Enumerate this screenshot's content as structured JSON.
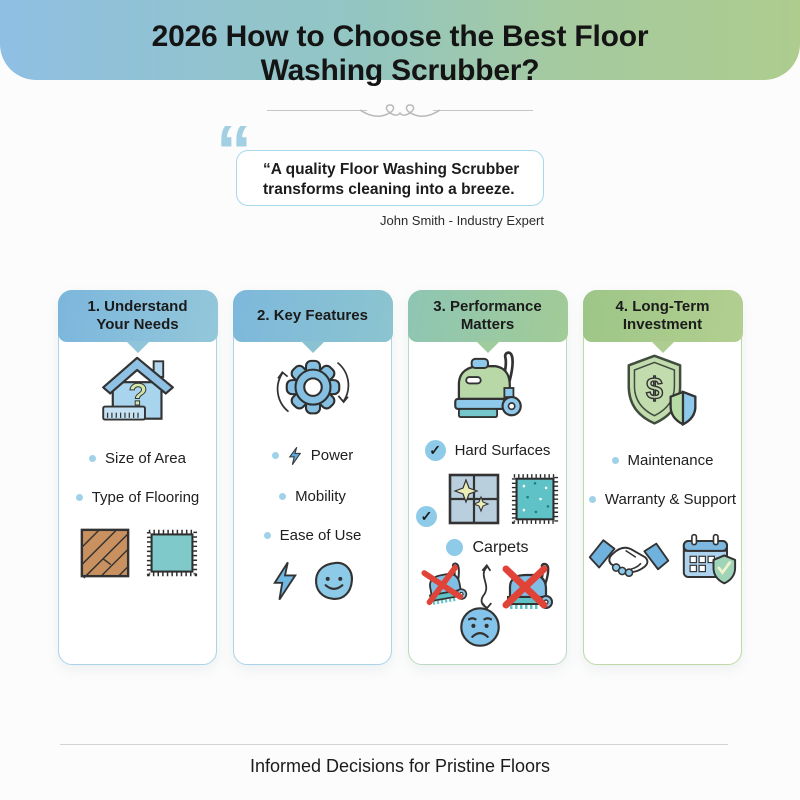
{
  "glyphs": {
    "quote_mark": "“",
    "check": "✓"
  },
  "header": {
    "title_line1": "2026 How to Choose the Best Floor",
    "title_line2": "Washing Scrubber?",
    "gradient_from": "#8fbfe3",
    "gradient_to": "#adcc8e"
  },
  "quote": {
    "text_line1": "“A quality Floor Washing Scrubber",
    "text_line2": "transforms cleaning into a breeze.",
    "attribution": "John Smith - Industry Expert",
    "border_color": "#a8d8ec",
    "mark_color": "#a3cfe3"
  },
  "columns": [
    {
      "title_line1": "1. Understand",
      "title_line2": "Your Needs",
      "header_gradient": [
        "#7cb6dc",
        "#93c7da"
      ],
      "icon": "house-question-ruler-icon",
      "bullets": [
        "Size of Area",
        "Type of Flooring"
      ],
      "images": [
        "wood-flooring-icon",
        "carpet-swatch-icon"
      ]
    },
    {
      "title_line1": "2. Key Features",
      "title_line2": "",
      "header_gradient": [
        "#7db8dc",
        "#8cc4cf"
      ],
      "icon": "gear-sync-arrows-icon",
      "bullets": [
        "Power",
        "Mobility",
        "Ease of Use"
      ],
      "images": [
        "lightning-bolt-icon",
        "smiley-face-icon"
      ]
    },
    {
      "title_line1": "3. Performance",
      "title_line2": "Matters",
      "header_gradient": [
        "#8ec6b4",
        "#a2cb96"
      ],
      "icon": "floor-scrubber-machine-icon",
      "check_items": [
        "Hard Surfaces"
      ],
      "carpet_label": "Carpets",
      "images": [
        "clean-tile-icon",
        "carpet-swatch-icon",
        "crossed-scrubber-icon",
        "crossed-scrubber-icon",
        "sad-face-icon"
      ]
    },
    {
      "title_line1": "4. Long-Term",
      "title_line2": "Investment",
      "header_gradient": [
        "#9dc687",
        "#b2cf90"
      ],
      "icon": "shield-dollar-icon",
      "bullets": [
        "Maintenance",
        "Warranty & Support"
      ],
      "images": [
        "handshake-icon",
        "calendar-warranty-icon"
      ]
    }
  ],
  "footer": {
    "tagline": "Informed Decisions for Pristine Floors"
  },
  "colors": {
    "accent_blue": "#8ecbe8",
    "accent_green": "#b9d8a8",
    "accent_teal": "#5ec2c6",
    "cross_red": "#e04438",
    "bullet_dot": "#9fd2e8",
    "text_dark": "#1b1b1b"
  }
}
